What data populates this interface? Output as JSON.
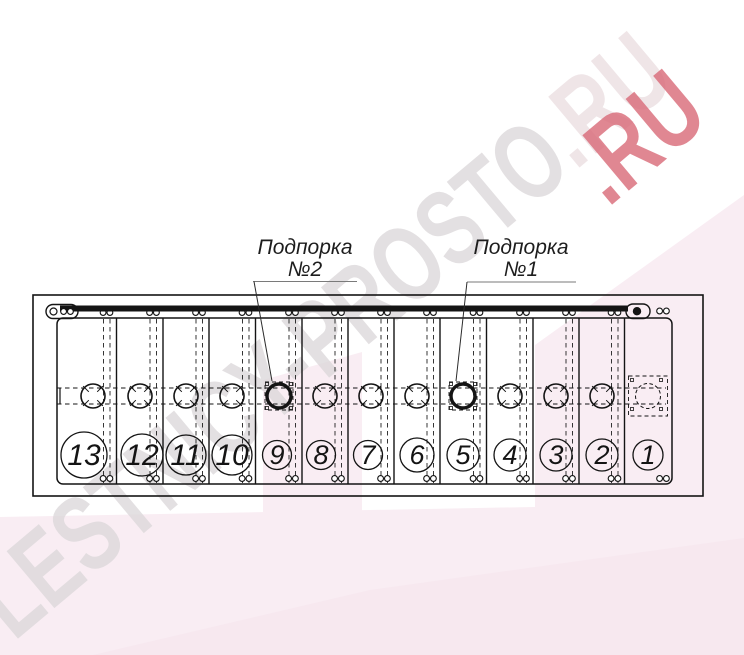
{
  "annotations": {
    "support2": {
      "line1": "Подпорка",
      "line2": "№2"
    },
    "support1": {
      "line1": "Подпорка",
      "line2": "№1"
    }
  },
  "steps": [
    {
      "number": "13"
    },
    {
      "number": "12"
    },
    {
      "number": "11"
    },
    {
      "number": "10"
    },
    {
      "number": "9"
    },
    {
      "number": "8"
    },
    {
      "number": "7"
    },
    {
      "number": "6"
    },
    {
      "number": "5"
    },
    {
      "number": "4"
    },
    {
      "number": "3"
    },
    {
      "number": "2"
    },
    {
      "number": "1"
    }
  ],
  "watermark": {
    "main": "LESTNICY-PROSTO",
    "tail": ".RU",
    "accent": ".RU"
  },
  "colors": {
    "pink": "#f9edf3",
    "pink_soft": "#f5e5ee",
    "watermark_gray": "#ddd9db",
    "watermark_red": "#d96a78",
    "line": "#141414"
  }
}
